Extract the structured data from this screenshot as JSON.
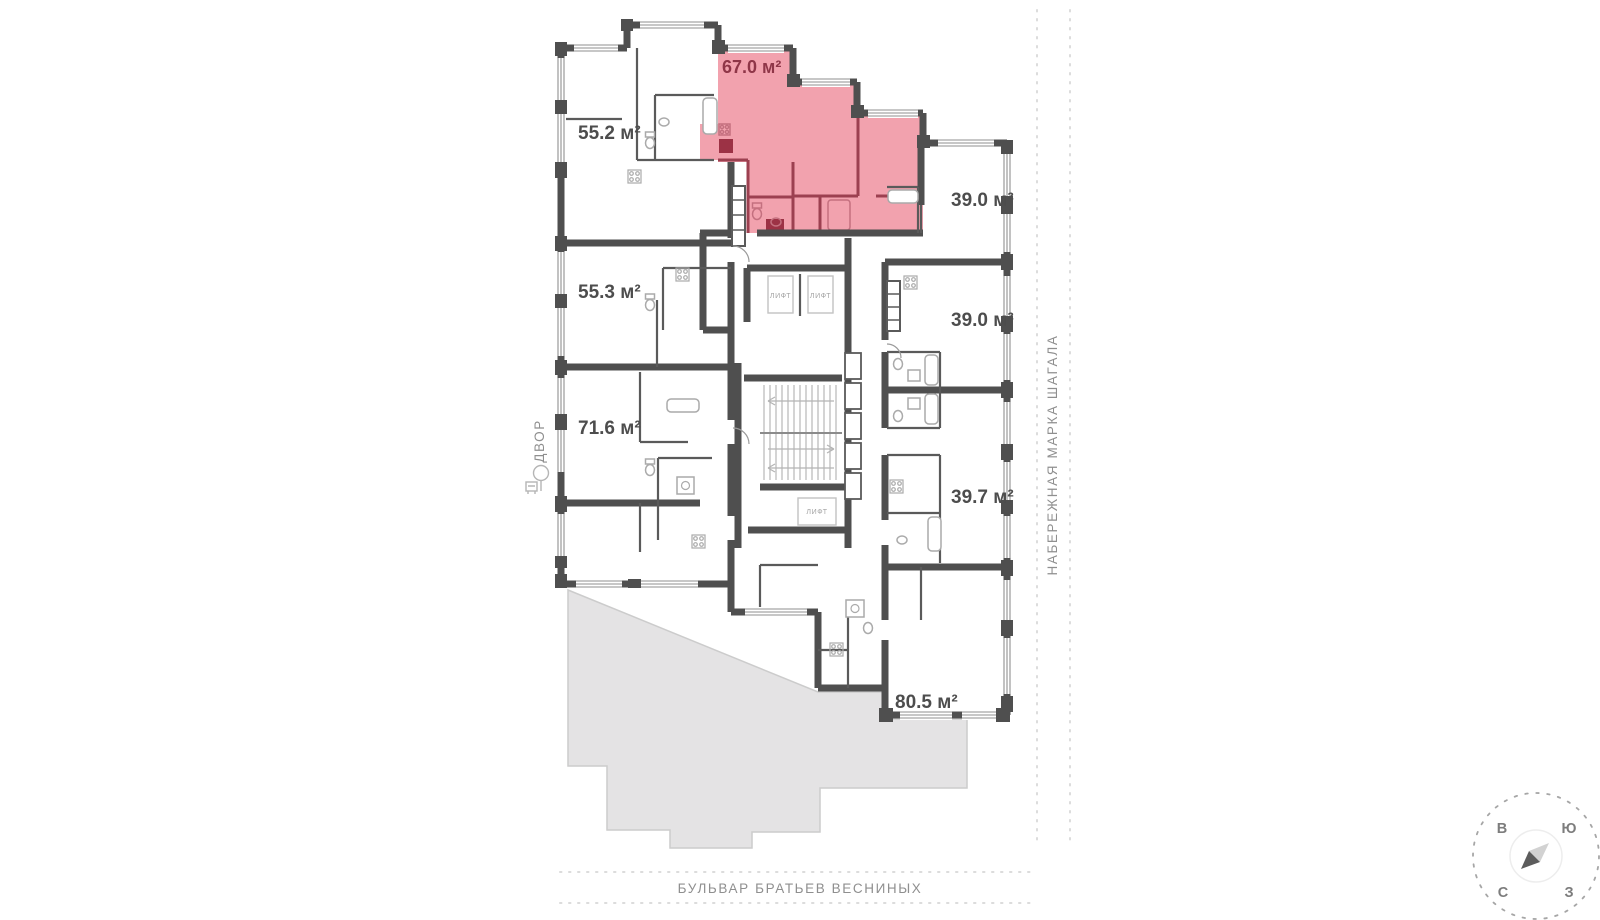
{
  "plan": {
    "apartments": [
      {
        "id": "apt-55-2",
        "area_label": "55.2 м²",
        "highlighted": false
      },
      {
        "id": "apt-55-3",
        "area_label": "55.3 м²",
        "highlighted": false
      },
      {
        "id": "apt-71-6",
        "area_label": "71.6 м²",
        "highlighted": false
      },
      {
        "id": "apt-67-0",
        "area_label": "67.0 м²",
        "highlighted": true
      },
      {
        "id": "apt-39-0-a",
        "area_label": "39.0 м²",
        "highlighted": false
      },
      {
        "id": "apt-39-0-b",
        "area_label": "39.0 м²",
        "highlighted": false
      },
      {
        "id": "apt-39-7",
        "area_label": "39.7 м²",
        "highlighted": false
      },
      {
        "id": "apt-80-5",
        "area_label": "80.5 м²",
        "highlighted": false
      }
    ],
    "elevator_label": "ЛИФТ",
    "colors": {
      "highlight_fill": "#f2a2ae",
      "highlight_wall": "#9c4050",
      "highlight_door": "#9c3245",
      "highlight_label": "#8f3648",
      "wall": "#4f4f4f",
      "area_label": "#4d4d4d",
      "adjacent_building_fill": "#e4e3e4",
      "street_label": "#8f8f8f"
    }
  },
  "surroundings": {
    "left_label": "ДВОР",
    "right_label": "НАБЕРЕЖНАЯ МАРКА ШАГАЛА",
    "bottom_label": "БУЛЬВАР БРАТЬЕВ ВЕСНИНЫХ"
  },
  "compass": {
    "east": "В",
    "south": "Ю",
    "north": "С",
    "west": "З"
  }
}
